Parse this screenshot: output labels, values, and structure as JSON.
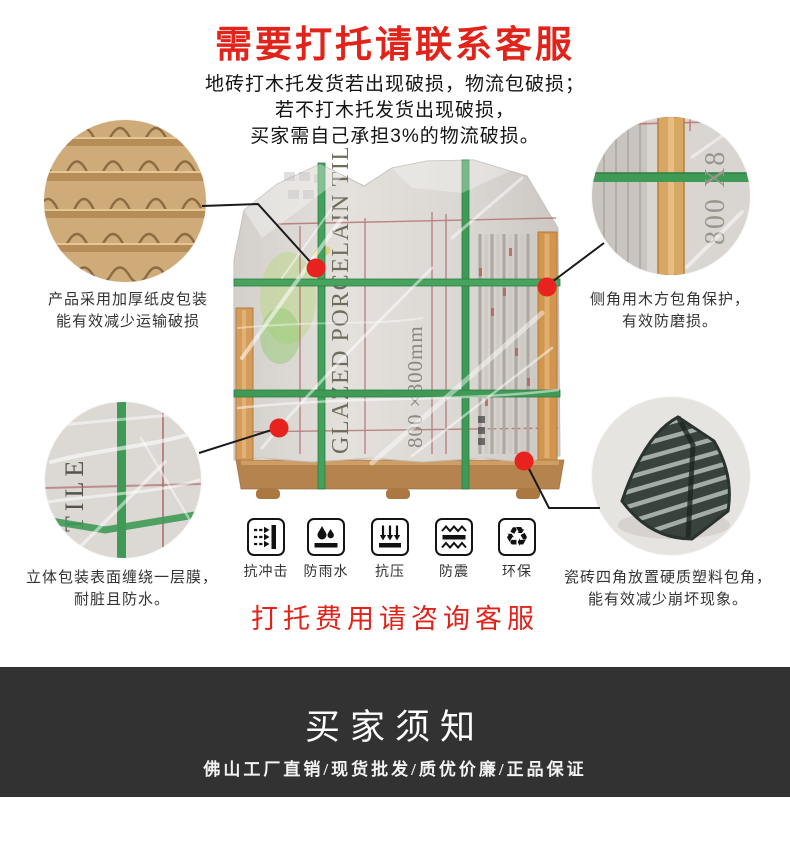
{
  "page": {
    "background": "#ffffff",
    "accent_red": "#e2231a",
    "strap_green": "#3f9a56",
    "wood_tan": "#c8935a",
    "banner_bg": "#323232"
  },
  "header": {
    "title": "需要打托请联系客服",
    "intro_lines": [
      "地砖打木托发货若出现破损，物流包破损；",
      "若不打木托发货出现破损，",
      "买家需自己承担3%的物流破损。"
    ]
  },
  "callouts": [
    {
      "id": "cardboard",
      "caption_line1": "产品采用加厚纸皮包装",
      "caption_line2": "能有效减少运输破损"
    },
    {
      "id": "wood-corner",
      "caption_line1": "侧角用木方包角保护，",
      "caption_line2": "有效防磨损。"
    },
    {
      "id": "film-wrap",
      "caption_line1": "立体包装表面缠绕一层膜，",
      "caption_line2": "耐脏且防水。"
    },
    {
      "id": "plastic-corner",
      "caption_line1": "瓷砖四角放置硬质塑料包角，",
      "caption_line2": "能有效减少崩坏现象。"
    }
  ],
  "product_image": {
    "package_text_vertical": "GLAZED PORCELAIN TILE",
    "package_size_text": "800 ×800mm",
    "detail_size_text": "800 X8",
    "film_circle_text": "TILE"
  },
  "features": [
    {
      "icon": "impact-icon",
      "label": "抗冲击"
    },
    {
      "icon": "rainproof-icon",
      "label": "防雨水"
    },
    {
      "icon": "pressure-icon",
      "label": "抗压"
    },
    {
      "icon": "shockproof-icon",
      "label": "防震"
    },
    {
      "icon": "eco-icon",
      "label": "环保",
      "glyph": "♻"
    }
  ],
  "note": {
    "text": "打托费用请咨询客服"
  },
  "footer": {
    "title": "买家须知",
    "subtitle": "佛山工厂直销/现货批发/质优价廉/正品保证"
  }
}
